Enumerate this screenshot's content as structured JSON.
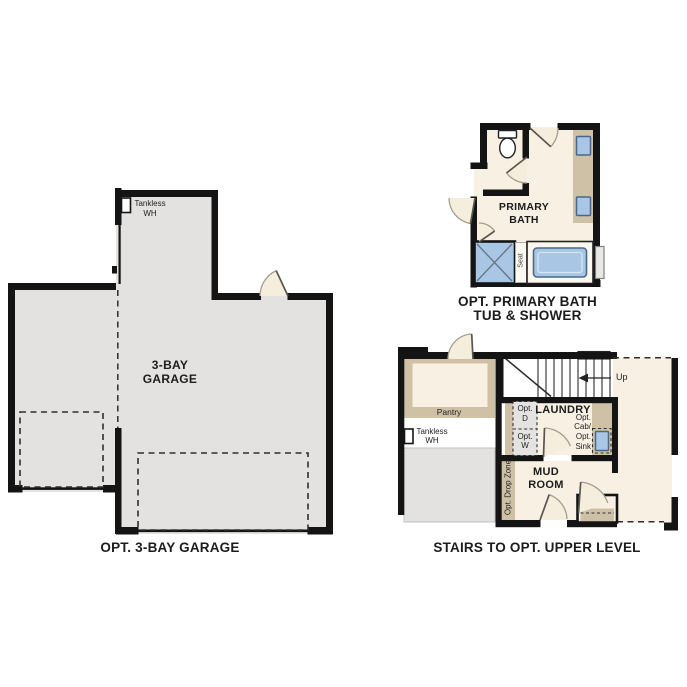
{
  "sheet_title": "floor-plan-options-sheet",
  "colors": {
    "wall": "#141414",
    "garage_fill": "#e3e2e0",
    "cream_fill": "#f7f0e3",
    "tan": "#cec1a5",
    "appliance_gray": "#e4e3e1",
    "fixture_blue": "#a9c7e5",
    "fixture_blue_border": "#49688c",
    "text": "#1c1c1c"
  },
  "garage_plan": {
    "caption": "OPT. 3-BAY GARAGE",
    "room_lines": [
      "3-BAY",
      "GARAGE"
    ],
    "tankless_lines": [
      "Tankless",
      "WH"
    ]
  },
  "bath_plan": {
    "caption_lines": [
      "OPT. PRIMARY BATH",
      "TUB & SHOWER"
    ],
    "room_lines": [
      "PRIMARY",
      "BATH"
    ],
    "seat_label": "Seat"
  },
  "stairs_plan": {
    "caption": "STAIRS TO OPT. UPPER LEVEL",
    "pantry_label": "Pantry",
    "tankless_lines": [
      "Tankless",
      "WH"
    ],
    "up_label": "Up",
    "laundry_label": "LAUNDRY",
    "opt_d_lines": [
      "Opt.",
      "D"
    ],
    "opt_w_lines": [
      "Opt.",
      "W"
    ],
    "opt_cab_lines": [
      "Opt.",
      "Cab/",
      "Opt.",
      "Sink"
    ],
    "mud_room_lines": [
      "MUD",
      "ROOM"
    ],
    "drop_zone_label": "Opt. Drop Zone"
  }
}
